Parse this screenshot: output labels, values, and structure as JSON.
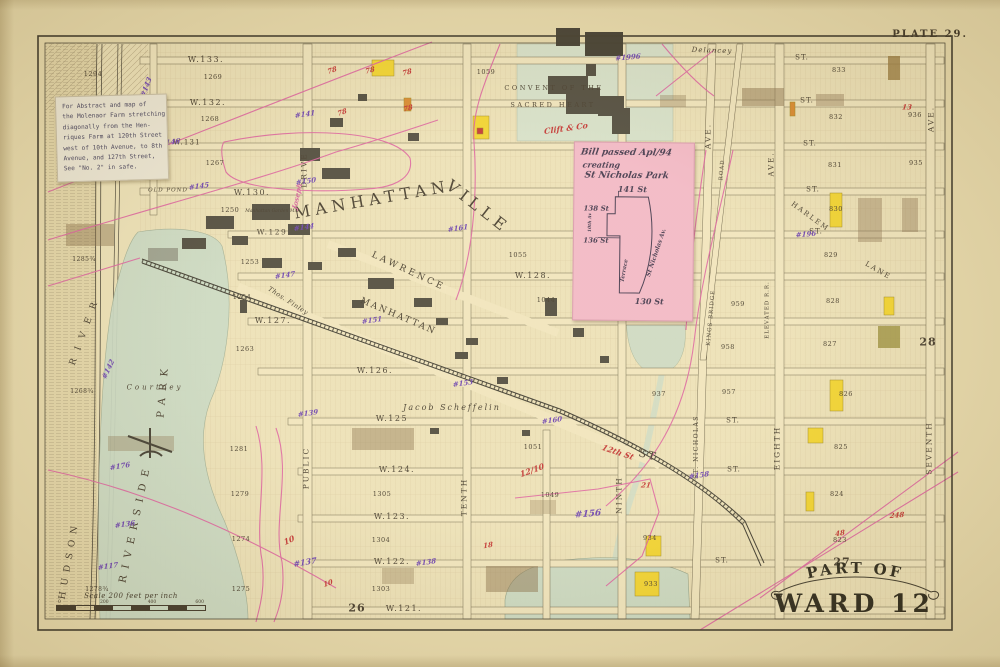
{
  "plate_label": "PLATE 29.",
  "banner": {
    "line1": "PART OF",
    "line2": "WARD 12"
  },
  "adjacent_plate_numbers": [
    "26",
    "27",
    "28"
  ],
  "notes": {
    "white_note": {
      "lines": [
        "For Abstract and map of",
        "the Molenaor Farm stretching",
        "diagonally from the Hen-",
        "riques Farm at 120th Street",
        "west of 10th Avenue, to 8th",
        "Avenue, and 127th Street,",
        "See \"No. 2\" in safe."
      ]
    },
    "pink_note": {
      "line1": "Bill passed Apl/94",
      "line2": "creating",
      "line3": "St Nicholas Park",
      "s141": "141 St",
      "s138": "138 St",
      "s136": "136 St",
      "s130": "130 St",
      "av10": "10th Av",
      "stnich": "St Nicholas Av.",
      "terrace": "Terrace"
    }
  },
  "scale_bar": {
    "label": "Scale 200 feet per inch",
    "ticks": [
      "0",
      "200",
      "400",
      "600"
    ]
  },
  "colors": {
    "k": "#43392a",
    "p": "#6a3fae",
    "r": "#c23230",
    "m": "#d55f9b",
    "paper": "#e7d9ab",
    "map_bg": "#ece0b6",
    "park_green": "#c9d9c4",
    "note_pink": "#f2b6c5",
    "boundary_pink": "#dd5f9e",
    "building_yellow": "#f2d32c",
    "building_orange": "#d8872b"
  },
  "label_format": [
    "text",
    "x",
    "y",
    "font_px",
    "rotate_deg",
    "color_key",
    "style_key",
    "letter_spacing_px"
  ],
  "map_labels": [
    [
      "W.133.",
      206,
      60,
      8,
      0,
      "k",
      "s",
      1.5
    ],
    [
      "W.132.",
      208,
      103,
      8,
      0,
      "k",
      "s",
      1.5
    ],
    [
      "W.131",
      187,
      143,
      7,
      0,
      "k",
      "s",
      1.2
    ],
    [
      "W.130.",
      252,
      193,
      8,
      0,
      "k",
      "s",
      1.5
    ],
    [
      "W.129",
      272,
      232,
      7.5,
      0,
      "k",
      "s",
      1.5
    ],
    [
      "W.128.",
      533,
      276,
      8,
      0,
      "k",
      "s",
      1.5
    ],
    [
      "W.127.",
      273,
      321,
      8,
      0,
      "k",
      "s",
      1.5
    ],
    [
      "W.126.",
      375,
      371,
      8,
      0,
      "k",
      "s",
      1.5
    ],
    [
      "W.125",
      392,
      419,
      8,
      0,
      "k",
      "s",
      1.5
    ],
    [
      "W.124.",
      397,
      470,
      8,
      0,
      "k",
      "s",
      1.5
    ],
    [
      "W.123.",
      392,
      517,
      8,
      0,
      "k",
      "s",
      1.5
    ],
    [
      "W.122.",
      392,
      562,
      8,
      0,
      "k",
      "s",
      1.5
    ],
    [
      "W.121.",
      404,
      609,
      8,
      0,
      "k",
      "s",
      1.5
    ],
    [
      "ST.",
      802,
      58,
      7,
      0,
      "k",
      "s",
      1
    ],
    [
      "ST.",
      807,
      101,
      7,
      0,
      "k",
      "s",
      1
    ],
    [
      "ST.",
      810,
      144,
      7,
      0,
      "k",
      "s",
      1
    ],
    [
      "ST.",
      813,
      190,
      7,
      0,
      "k",
      "s",
      1
    ],
    [
      "ST.",
      816,
      232,
      7,
      0,
      "k",
      "s",
      1
    ],
    [
      "ST.",
      733,
      421,
      7,
      0,
      "k",
      "s",
      1
    ],
    [
      "ST.",
      734,
      470,
      7,
      0,
      "k",
      "s",
      1
    ],
    [
      "ST.",
      722,
      561,
      7,
      0,
      "k",
      "s",
      1
    ],
    [
      "ST",
      648,
      455,
      11,
      15,
      "k",
      "s",
      2
    ],
    [
      "DRIVE",
      304,
      170,
      7.5,
      -90,
      "k",
      "s",
      2
    ],
    [
      "PUBLIC",
      306,
      468,
      7.5,
      -90,
      "k",
      "s",
      2
    ],
    [
      "TENTH",
      464,
      497,
      7.5,
      -90,
      "k",
      "s",
      2
    ],
    [
      "NINTH",
      619,
      495,
      7.5,
      -90,
      "k",
      "s",
      2
    ],
    [
      "EIGHTH",
      777,
      448,
      7.5,
      -90,
      "k",
      "s",
      2
    ],
    [
      "SEVENTH",
      929,
      448,
      7.5,
      -90,
      "k",
      "s",
      2
    ],
    [
      "ST. NICHOLAS",
      697,
      447,
      6,
      -90,
      "k",
      "s",
      1.5
    ],
    [
      "AVE.",
      150,
      130,
      7.5,
      -90,
      "k",
      "s",
      2
    ],
    [
      "AVE.",
      708,
      136,
      7.5,
      -90,
      "k",
      "s",
      2
    ],
    [
      "AVE.",
      931,
      119,
      7.5,
      -90,
      "k",
      "s",
      2
    ],
    [
      "AVE.",
      772,
      164,
      7,
      -90,
      "k",
      "s",
      2
    ],
    [
      "ELEVATED R.R.",
      768,
      310,
      5.5,
      -90,
      "k",
      "s",
      1
    ],
    [
      "KINGS BRIDGE",
      712,
      318,
      5.5,
      -85,
      "k",
      "s",
      1
    ],
    [
      "ROAD",
      723,
      170,
      5.5,
      -85,
      "k",
      "s",
      1
    ],
    [
      "MANHATTAN",
      372,
      200,
      16,
      -10,
      "k",
      "s",
      5
    ],
    [
      "VILLE",
      478,
      207,
      16,
      38,
      "k",
      "s",
      5
    ],
    [
      "LAWRENCE",
      408,
      272,
      9,
      25,
      "k",
      "s",
      3
    ],
    [
      "MANHATTAN",
      398,
      317,
      9,
      23,
      "k",
      "s",
      2
    ],
    [
      "RIVERSIDE",
      136,
      523,
      10,
      -78,
      "k",
      "s",
      7
    ],
    [
      "PARK",
      164,
      390,
      10,
      -85,
      "k",
      "s",
      7
    ],
    [
      "HUDSON",
      70,
      560,
      9,
      -80,
      "k",
      "s",
      6
    ],
    [
      "RIVER",
      86,
      330,
      9,
      -70,
      "k",
      "s",
      9
    ],
    [
      "CONVENT OF THE",
      554,
      88,
      6.5,
      0,
      "k",
      "s",
      2.5
    ],
    [
      "SACRED HEART",
      553,
      105,
      6.5,
      0,
      "k",
      "s",
      2.5
    ],
    [
      "Courtney",
      155,
      388,
      7,
      0,
      "k",
      "i",
      3
    ],
    [
      "Jacob Scheffelin",
      452,
      408,
      8,
      0,
      "k",
      "i",
      2
    ],
    [
      "Delancey",
      712,
      51,
      7,
      2,
      "k",
      "i",
      1
    ],
    [
      "HARLEM",
      810,
      217,
      7,
      36,
      "k",
      "s",
      2
    ],
    [
      "LANE",
      878,
      271,
      7,
      30,
      "k",
      "s",
      2
    ],
    [
      "Thos. Finley",
      288,
      301,
      6.5,
      33,
      "k",
      "i",
      0.5
    ],
    [
      "OLD POND",
      168,
      191,
      5.5,
      0,
      "k",
      "i",
      1
    ],
    [
      "Manhattan Garden Mill",
      272,
      212,
      4.5,
      0,
      "k",
      "i",
      0
    ],
    [
      "Joseph",
      297,
      196,
      7,
      -78,
      "m",
      "h",
      0
    ],
    [
      "1294",
      93,
      74,
      6.5,
      0,
      "k",
      "s",
      0.5
    ],
    [
      "1269",
      213,
      77,
      6.5,
      0,
      "k",
      "s",
      0.5
    ],
    [
      "1268",
      210,
      119,
      6.5,
      0,
      "k",
      "s",
      0.5
    ],
    [
      "1267",
      215,
      163,
      6.5,
      0,
      "k",
      "s",
      0.5
    ],
    [
      "1250",
      230,
      210,
      6.5,
      0,
      "k",
      "s",
      0.5
    ],
    [
      "1253",
      250,
      262,
      6.5,
      0,
      "k",
      "s",
      0.5
    ],
    [
      "1254",
      242,
      297,
      6.5,
      0,
      "k",
      "s",
      0.5
    ],
    [
      "1263",
      245,
      349,
      6.5,
      0,
      "k",
      "s",
      0.5
    ],
    [
      "1285¾",
      84,
      260,
      6,
      0,
      "k",
      "s",
      0.5
    ],
    [
      "1268¾",
      82,
      392,
      6,
      0,
      "k",
      "s",
      0.5
    ],
    [
      "1278¾",
      97,
      590,
      6,
      0,
      "k",
      "s",
      0.5
    ],
    [
      "1281",
      239,
      449,
      6.5,
      0,
      "k",
      "s",
      0.5
    ],
    [
      "1279",
      240,
      494,
      6.5,
      0,
      "k",
      "s",
      0.5
    ],
    [
      "1274",
      241,
      539,
      6.5,
      0,
      "k",
      "s",
      0.5
    ],
    [
      "1275",
      241,
      589,
      6.5,
      0,
      "k",
      "s",
      0.5
    ],
    [
      "1305",
      382,
      494,
      6.5,
      0,
      "k",
      "s",
      0.5
    ],
    [
      "1304",
      381,
      540,
      6.5,
      0,
      "k",
      "s",
      0.5
    ],
    [
      "1303",
      381,
      589,
      6.5,
      0,
      "k",
      "s",
      0.5
    ],
    [
      "1059",
      486,
      72,
      6.5,
      0,
      "k",
      "s",
      0.5
    ],
    [
      "1055",
      518,
      255,
      6.5,
      0,
      "k",
      "s",
      0.5
    ],
    [
      "1051",
      533,
      447,
      6.5,
      0,
      "k",
      "s",
      0.5
    ],
    [
      "1049",
      550,
      495,
      6.5,
      0,
      "k",
      "s",
      0.5
    ],
    [
      "1044",
      546,
      300,
      6.5,
      0,
      "k",
      "s",
      0.5
    ],
    [
      "955",
      648,
      201,
      6.5,
      0,
      "k",
      "s",
      0.5
    ],
    [
      "958",
      728,
      347,
      6.5,
      0,
      "k",
      "s",
      0.5
    ],
    [
      "957",
      729,
      392,
      6.5,
      0,
      "k",
      "s",
      0.5
    ],
    [
      "937",
      659,
      394,
      6.5,
      0,
      "k",
      "s",
      0.5
    ],
    [
      "959",
      738,
      304,
      6.5,
      0,
      "k",
      "s",
      0.5
    ],
    [
      "832",
      836,
      117,
      6.5,
      0,
      "k",
      "s",
      0.5
    ],
    [
      "831",
      835,
      165,
      6.5,
      0,
      "k",
      "s",
      0.5
    ],
    [
      "830",
      836,
      209,
      6.5,
      0,
      "k",
      "s",
      0.5
    ],
    [
      "829",
      831,
      255,
      6.5,
      0,
      "k",
      "s",
      0.5
    ],
    [
      "828",
      833,
      301,
      6.5,
      0,
      "k",
      "s",
      0.5
    ],
    [
      "827",
      830,
      344,
      6.5,
      0,
      "k",
      "s",
      0.5
    ],
    [
      "826",
      846,
      394,
      6.5,
      0,
      "k",
      "s",
      0.5
    ],
    [
      "825",
      841,
      447,
      6.5,
      0,
      "k",
      "s",
      0.5
    ],
    [
      "824",
      837,
      494,
      6.5,
      0,
      "k",
      "s",
      0.5
    ],
    [
      "823",
      840,
      540,
      6.5,
      0,
      "k",
      "s",
      0.5
    ],
    [
      "833",
      839,
      70,
      6.5,
      0,
      "k",
      "s",
      0.5
    ],
    [
      "936",
      915,
      115,
      6.5,
      0,
      "k",
      "s",
      0.5
    ],
    [
      "935",
      916,
      163,
      6.5,
      0,
      "k",
      "s",
      0.5
    ],
    [
      "934",
      650,
      538,
      6.5,
      0,
      "k",
      "s",
      0.5
    ],
    [
      "933",
      651,
      584,
      6.5,
      0,
      "k",
      "s",
      0.5
    ],
    [
      "26",
      357,
      608,
      11,
      0,
      "k",
      "b",
      1
    ],
    [
      "27",
      842,
      562,
      11,
      0,
      "k",
      "b",
      1
    ],
    [
      "28",
      928,
      342,
      11,
      0,
      "k",
      "b",
      1
    ],
    [
      "#143",
      146,
      87,
      7,
      -70,
      "p",
      "h",
      0
    ],
    [
      "#146",
      170,
      142,
      7,
      -8,
      "p",
      "h",
      0
    ],
    [
      "#145",
      199,
      186,
      7,
      -8,
      "p",
      "h",
      0
    ],
    [
      "#150",
      306,
      181,
      7,
      -8,
      "p",
      "h",
      0
    ],
    [
      "#141",
      305,
      114,
      7,
      -8,
      "p",
      "h",
      0
    ],
    [
      "#144",
      304,
      227,
      7,
      -8,
      "p",
      "h",
      0
    ],
    [
      "#161",
      458,
      228,
      7,
      -8,
      "p",
      "h",
      0
    ],
    [
      "#147",
      285,
      275,
      7,
      -8,
      "p",
      "h",
      0
    ],
    [
      "#151",
      372,
      320,
      7,
      -8,
      "p",
      "h",
      0
    ],
    [
      "#153",
      463,
      383,
      7,
      -8,
      "p",
      "h",
      0
    ],
    [
      "#160",
      552,
      420,
      7,
      -8,
      "p",
      "h",
      0
    ],
    [
      "#156",
      588,
      515,
      9,
      -5,
      "p",
      "h",
      0
    ],
    [
      "#137",
      305,
      562,
      8,
      -10,
      "p",
      "h",
      0
    ],
    [
      "#139",
      308,
      413,
      7,
      -8,
      "p",
      "h",
      0
    ],
    [
      "#138",
      426,
      562,
      7,
      -8,
      "p",
      "h",
      0
    ],
    [
      "#136",
      125,
      524,
      7,
      -8,
      "p",
      "h",
      0
    ],
    [
      "#142",
      108,
      369,
      7,
      -65,
      "p",
      "h",
      0
    ],
    [
      "#176",
      120,
      466,
      7,
      -10,
      "p",
      "h",
      0
    ],
    [
      "#158",
      699,
      475,
      7,
      -8,
      "p",
      "h",
      0
    ],
    [
      "#196",
      806,
      234,
      7,
      -5,
      "p",
      "h",
      0
    ],
    [
      "#1996",
      628,
      57,
      7,
      -5,
      "p",
      "h",
      0
    ],
    [
      "#117",
      108,
      566,
      7,
      -8,
      "p",
      "h",
      0
    ],
    [
      "78",
      332,
      70,
      7,
      -20,
      "r",
      "h",
      0
    ],
    [
      "78",
      370,
      70,
      7,
      -15,
      "r",
      "h",
      0
    ],
    [
      "78",
      407,
      72,
      7,
      -15,
      "r",
      "h",
      0
    ],
    [
      "78",
      342,
      112,
      7,
      -20,
      "r",
      "h",
      0
    ],
    [
      "78",
      408,
      108,
      7,
      -15,
      "r",
      "h",
      0
    ],
    [
      "Clift & Co",
      566,
      128,
      8,
      -8,
      "r",
      "h",
      0
    ],
    [
      "10",
      289,
      540,
      8,
      -25,
      "r",
      "h",
      0
    ],
    [
      "12/10",
      532,
      470,
      8,
      -20,
      "r",
      "h",
      0
    ],
    [
      "18",
      488,
      545,
      7,
      -10,
      "r",
      "h",
      0
    ],
    [
      "10",
      328,
      583,
      7,
      -20,
      "r",
      "h",
      0
    ],
    [
      "13",
      907,
      107,
      7,
      0,
      "r",
      "h",
      0
    ],
    [
      "21",
      646,
      485,
      7,
      0,
      "r",
      "h",
      0
    ],
    [
      "48",
      840,
      533,
      7,
      -10,
      "r",
      "h",
      0
    ],
    [
      "248",
      897,
      515,
      7,
      -5,
      "r",
      "h",
      0
    ],
    [
      "12th St",
      618,
      452,
      8,
      18,
      "r",
      "h",
      0
    ]
  ]
}
